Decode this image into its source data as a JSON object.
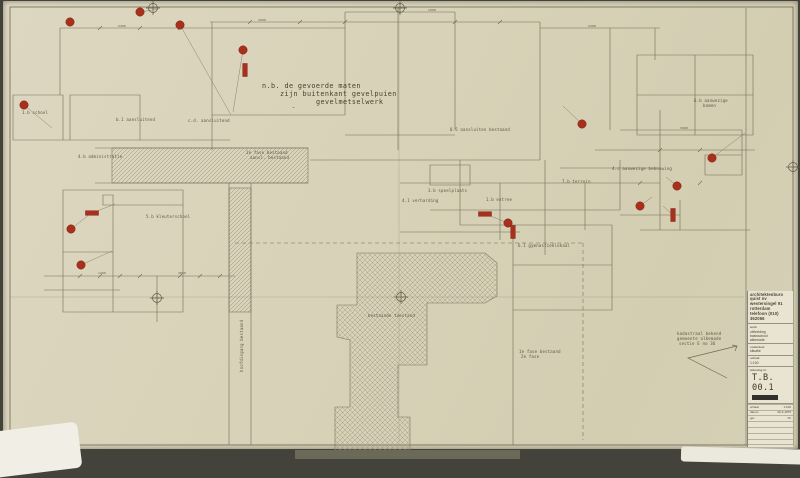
{
  "colors": {
    "paper": "#d8d2b8",
    "ink": "#6f6756",
    "hatch": "#968e78",
    "marker_red": "#a9301c",
    "background": "#43433b",
    "titleblock_bg": "#e9e4d1"
  },
  "note": {
    "l1": "n.b. de gevoerde maten",
    "l2": "zijn buitenkant gevelpuien",
    "l3": "gevelmetselwerk",
    "l4": "″"
  },
  "drawing": {
    "labels": [
      {
        "t": "b.1 aansluitend",
        "x": 116,
        "y": 118
      },
      {
        "t": "c.d. aansluitend",
        "x": 188,
        "y": 119
      },
      {
        "t": "1.b school",
        "x": 22,
        "y": 111
      },
      {
        "t": "4.b administratie",
        "x": 78,
        "y": 155
      },
      {
        "t": "1e fase bestaand",
        "x": 246,
        "y": 151
      },
      {
        "t": "aansl. bestaand",
        "x": 250,
        "y": 156
      },
      {
        "t": "5.b kleuterschool",
        "x": 146,
        "y": 215
      },
      {
        "t": "0.5 aansluiten bestaand",
        "x": 450,
        "y": 128
      },
      {
        "t": "3.b speelplaats",
        "x": 428,
        "y": 189
      },
      {
        "t": "4.1 verharding",
        "x": 402,
        "y": 199
      },
      {
        "t": "1.b entree",
        "x": 486,
        "y": 198
      },
      {
        "t": "6.1 gymnastieklokaal",
        "x": 518,
        "y": 244
      },
      {
        "t": "4.c aanwezige bebouwing",
        "x": 612,
        "y": 167
      },
      {
        "t": "7.b terrein",
        "x": 562,
        "y": 180
      },
      {
        "t": "6.b aanwezige",
        "x": 694,
        "y": 99
      },
      {
        "t": "bomen",
        "x": 703,
        "y": 104
      },
      {
        "t": "bestaande toestand",
        "x": 368,
        "y": 314
      },
      {
        "t": "1e fase bestaand",
        "x": 519,
        "y": 350
      },
      {
        "t": "2e fase",
        "x": 521,
        "y": 355
      },
      {
        "t": "kadastraal bekend",
        "x": 677,
        "y": 332
      },
      {
        "t": "gemeente alkemade",
        "x": 677,
        "y": 337
      },
      {
        "t": "sectie E no 36",
        "x": 679,
        "y": 342
      },
      {
        "t": "hoofdingang bestaand",
        "x": 240,
        "y": 372,
        "rot": -90
      },
      {
        "t": "2400",
        "x": 118,
        "y": 24,
        "fs": 3
      },
      {
        "t": "3600",
        "x": 258,
        "y": 18,
        "fs": 3
      },
      {
        "t": "1800",
        "x": 428,
        "y": 8,
        "fs": 3
      },
      {
        "t": "2400",
        "x": 588,
        "y": 24,
        "fs": 3
      },
      {
        "t": "1200",
        "x": 98,
        "y": 271,
        "fs": 3
      },
      {
        "t": "4800",
        "x": 178,
        "y": 271,
        "fs": 3
      },
      {
        "t": "3600",
        "x": 680,
        "y": 126,
        "fs": 3
      }
    ],
    "red_markers": {
      "dots": [
        [
          70,
          22
        ],
        [
          140,
          12
        ],
        [
          180,
          25
        ],
        [
          243,
          50
        ],
        [
          24,
          105
        ],
        [
          71,
          229
        ],
        [
          81,
          265
        ],
        [
          582,
          124
        ],
        [
          712,
          158
        ],
        [
          677,
          186
        ],
        [
          640,
          206
        ],
        [
          508,
          223
        ]
      ],
      "bars": [
        {
          "x": 245,
          "y": 70,
          "o": "v"
        },
        {
          "x": 92,
          "y": 213,
          "o": "h"
        },
        {
          "x": 485,
          "y": 214,
          "o": "h"
        },
        {
          "x": 513,
          "y": 232,
          "o": "v"
        },
        {
          "x": 673,
          "y": 215,
          "o": "v"
        }
      ]
    }
  },
  "title_block": {
    "firm": [
      "architektenburo",
      "quist nv",
      "westersingel 91",
      "rotterdam",
      "telefoon (010) 362066"
    ],
    "werk_label": "werk",
    "werk_lines": [
      "uitbreiding",
      "basisschool",
      "alkemade"
    ],
    "onderdeel_label": "onderdeel",
    "onderdeel_value": "situatie",
    "schaal_label": "schaal",
    "schaal_value": "1:100",
    "number_label": "tekening nr.",
    "drawing_number": "T.B. 00.1",
    "revision_rows": [
      {
        "l": "schaal",
        "v": "1:100"
      },
      {
        "l": "datum",
        "v": "26-3-1975"
      },
      {
        "l": "get.",
        "v": "hb"
      }
    ],
    "format_label": "formaat",
    "format_value": "A0"
  }
}
